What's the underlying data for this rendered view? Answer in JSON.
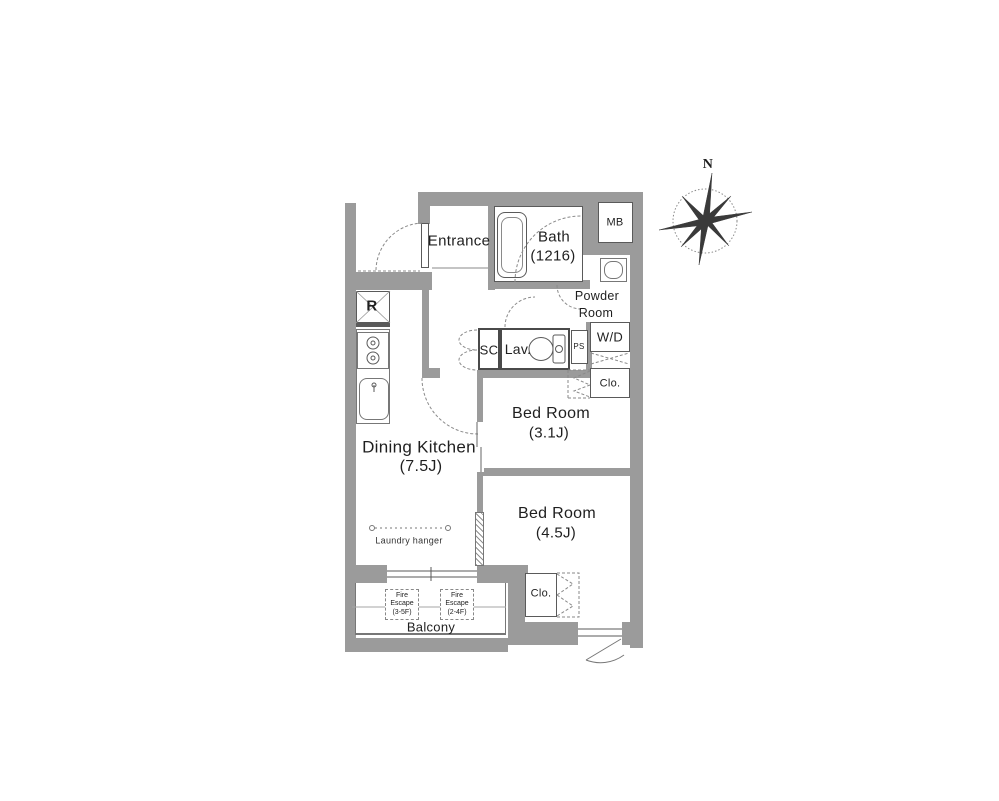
{
  "title": "Apartment floor plan",
  "colors": {
    "wall": "#9b9b9b",
    "line": "#5a5a5a",
    "dash": "#8a8a8a",
    "text": "#1f1f1f"
  },
  "compass": {
    "north_label": "N"
  },
  "rooms": {
    "entrance": {
      "label": "Entrance"
    },
    "bath": {
      "label": "Bath",
      "size": "(1216)"
    },
    "meter_box": {
      "label": "MB"
    },
    "powder_room": {
      "line1": "Powder",
      "line2": "Room"
    },
    "washer_dryer": {
      "label": "W/D"
    },
    "shoe_closet": {
      "label": "SC"
    },
    "lavatory": {
      "label": "Lav."
    },
    "pipe_space": {
      "label": "PS"
    },
    "closet_bedroom1": {
      "label": "Clo."
    },
    "bedroom1": {
      "label": "Bed Room",
      "size": "(3.1J)"
    },
    "bedroom2": {
      "label": "Bed Room",
      "size": "(4.5J)"
    },
    "closet_bedroom2": {
      "label": "Clo."
    },
    "dining_kitchen": {
      "label": "Dining Kitchen",
      "size": "(7.5J)"
    },
    "refrigerator": {
      "label": "R"
    },
    "balcony": {
      "label": "Balcony"
    },
    "laundry_hanger": {
      "label": "Laundry hanger"
    },
    "fire_escape_1": {
      "line1": "Fire",
      "line2": "Escape",
      "line3": "(3-5F)"
    },
    "fire_escape_2": {
      "line1": "Fire",
      "line2": "Escape",
      "line3": "(2-4F)"
    }
  }
}
